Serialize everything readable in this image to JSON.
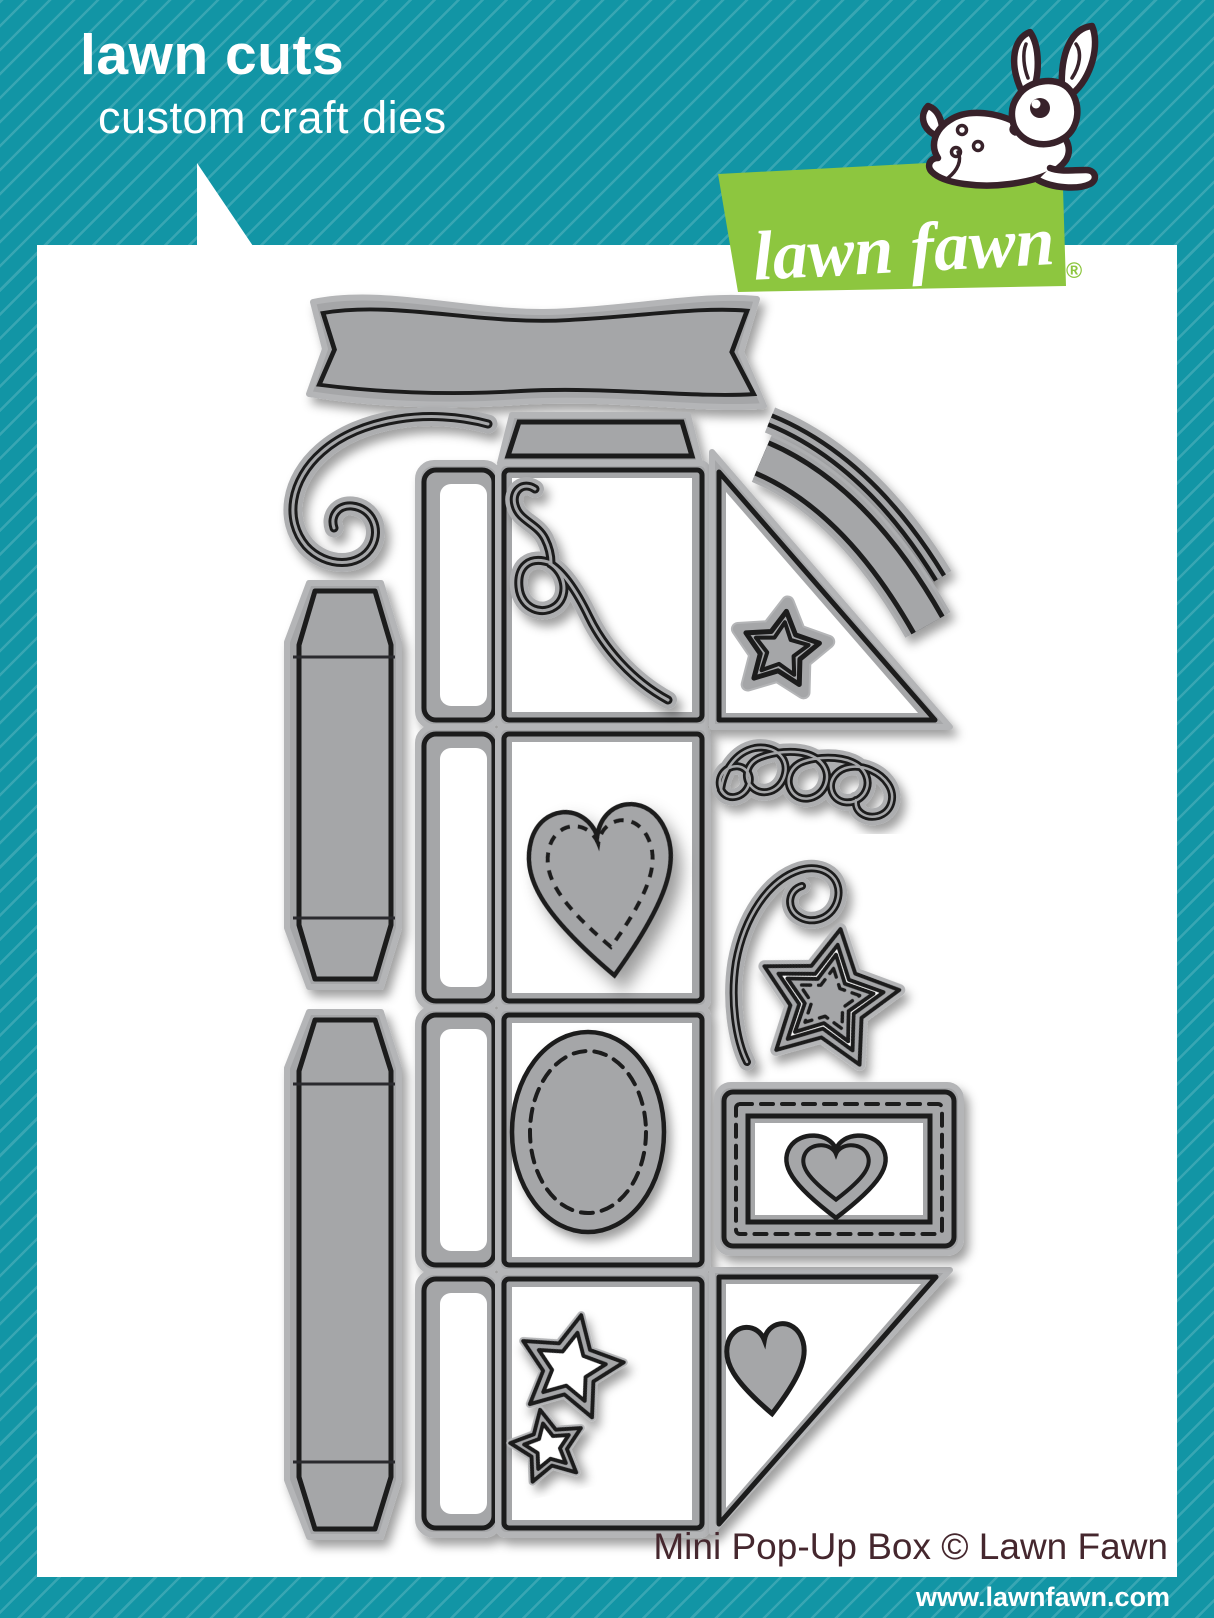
{
  "header": {
    "title": "lawn cuts",
    "subtitle": "custom craft dies"
  },
  "logo": {
    "brand": "lawn fawn",
    "registered_mark": "®"
  },
  "footer": {
    "product_title": "Mini Pop-Up Box © Lawn Fawn",
    "website": "www.lawnfawn.com"
  },
  "colors": {
    "teal_background": "#1295A5",
    "teal_stripe": "rgba(255,255,255,0.16)",
    "brand_green": "#8DC63F",
    "die_metal_gray": "#a5a6a8",
    "die_soft_edge": "#b4b5b7",
    "die_cut_line": "#1b1b1d",
    "product_text_maroon": "#45272e",
    "fawn_outline_brown": "#38222a",
    "panel_white": "#ffffff"
  },
  "dies": {
    "set_name": "Mini Pop-Up Box",
    "pieces": [
      {
        "name": "swallowtail-banner-die",
        "shape": "wavy banner with notched ends"
      },
      {
        "name": "swirl-flourish-die",
        "shape": "large curled swirl"
      },
      {
        "name": "side-strip-die-1",
        "shape": "tall beveled strip with score lines"
      },
      {
        "name": "side-strip-die-2",
        "shape": "tall beveled strip with score lines"
      },
      {
        "name": "pop-up-box-template-die",
        "shape": "four panel box body with side flaps and top flap"
      },
      {
        "name": "curly-streamer-die",
        "shape": "looped streamer inside panel 1"
      },
      {
        "name": "stitched-heart-die",
        "shape": "heart with stitch line inside panel 2"
      },
      {
        "name": "stitched-oval-die",
        "shape": "oval with stitch line inside panel 3"
      },
      {
        "name": "star-outline-large-die",
        "shape": "open star inside panel 4"
      },
      {
        "name": "star-outline-small-die",
        "shape": "open star inside panel 4"
      },
      {
        "name": "curved-strip-thin-die",
        "shape": "narrow curved border strip"
      },
      {
        "name": "curved-strip-wide-die",
        "shape": "wide curved border strip"
      },
      {
        "name": "popup-triangle-top-die",
        "shape": "right triangle support with framed star"
      },
      {
        "name": "popup-triangle-bottom-die",
        "shape": "right triangle support with solid heart"
      },
      {
        "name": "loop-doodle-die",
        "shape": "triple loop script flourish"
      },
      {
        "name": "spiral-curl-die",
        "shape": "curl with spiral head"
      },
      {
        "name": "stitched-star-in-frame-die",
        "shape": "stitched star inside star frame"
      },
      {
        "name": "stitched-rectangle-frame-die",
        "shape": "stitched rectangle frame with double heart"
      }
    ]
  }
}
